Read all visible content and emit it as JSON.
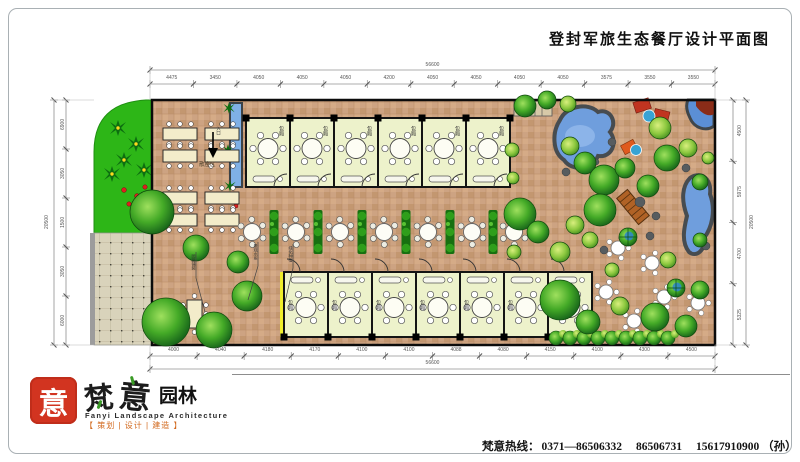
{
  "title": "登封军旅生态餐厅设计平面图",
  "plan": {
    "room_label": "包厢",
    "open_seating_label": "散座区",
    "entrance_label": "入口",
    "callouts": [
      "景观水系",
      "绿化种植",
      "园路铺装"
    ]
  },
  "dimensions": {
    "top": {
      "total": "56600",
      "segments": [
        "4475",
        "3450",
        "4050",
        "4050",
        "4050",
        "4200",
        "4050",
        "4050",
        "4050",
        "4050",
        "3575",
        "3550",
        "3550"
      ]
    },
    "bottom": {
      "total": "56600",
      "segments": [
        "4000",
        "4040",
        "4180",
        "4170",
        "4100",
        "4100",
        "4088",
        "4080",
        "4150",
        "4100",
        "4300",
        "4500"
      ]
    },
    "left": {
      "total": "20500",
      "segments": [
        "6900",
        "3050",
        "1500",
        "3050",
        "6000"
      ]
    },
    "right": {
      "total": "20500",
      "segments": [
        "4500",
        "5975",
        "4700",
        "5325"
      ]
    }
  },
  "footer": {
    "hotline_label": "梵意热线：",
    "phones": [
      "0371—86506332",
      "86506731",
      "15617910900 （孙）"
    ],
    "logo": {
      "seal_char": "意",
      "brand_first": "梵",
      "brand_second": "意",
      "brand_suffix": "园林",
      "brand_en": "Fanyi Landscape Architecture",
      "tagline": "【 策划 | 设计 | 建造 】"
    }
  }
}
